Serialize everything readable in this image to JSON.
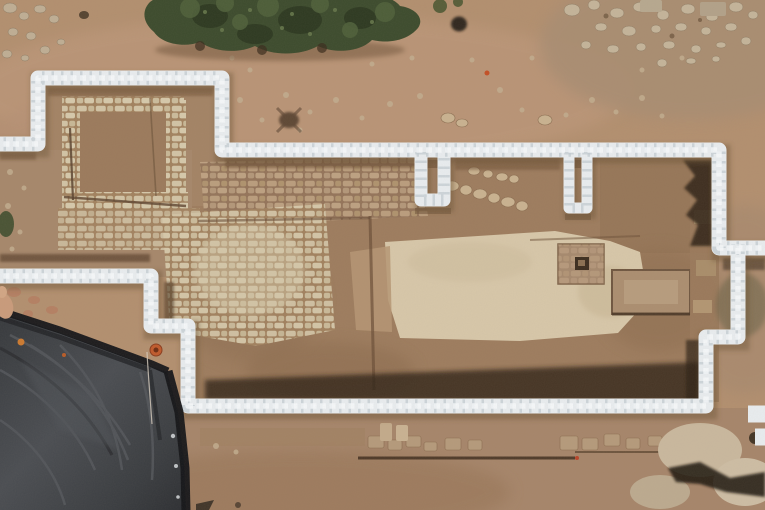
{
  "scene": {
    "type": "aerial-drone-photograph",
    "subject": "archaeological excavation site outlined with white sandbag walls, stone foundations and pavements inside, dark protective tarp at lower left, shrub canopy at top",
    "alt": "Top-down aerial photo of an archaeological dig: tan earth, a stepped perimeter of white sandbags enclosing exposed stone walls, cobbled pavements and a pale plaster floor; a square installation with a dark socket; a large dark gray tarp covers the lower-left corner; dense green shrubs at top; scattered rubble and field stones elsewhere."
  },
  "palette": {
    "soil_base": "#b28f6f",
    "soil_top": "#bb9678",
    "soil_interior": "#9d7c5e",
    "soil_dark": "#8a6a4e",
    "floor_pale": "#d7c7a9",
    "stone_light": "#cfc0a2",
    "stone_mid": "#b59a7b",
    "sandbag_white": "#e9edf0",
    "sandbag_seam": "#c3ccd3",
    "shadow_dark": "#2f2114",
    "tarp_mid": "#3f4246",
    "tarp_edge": "#141518",
    "tarp_fold": "#54575c",
    "vegetation_dark": "#3c4b2d",
    "vegetation_light": "#4e5f3a",
    "marker_orange": "#c05a2c",
    "skin_tone": "#c99b7b"
  }
}
